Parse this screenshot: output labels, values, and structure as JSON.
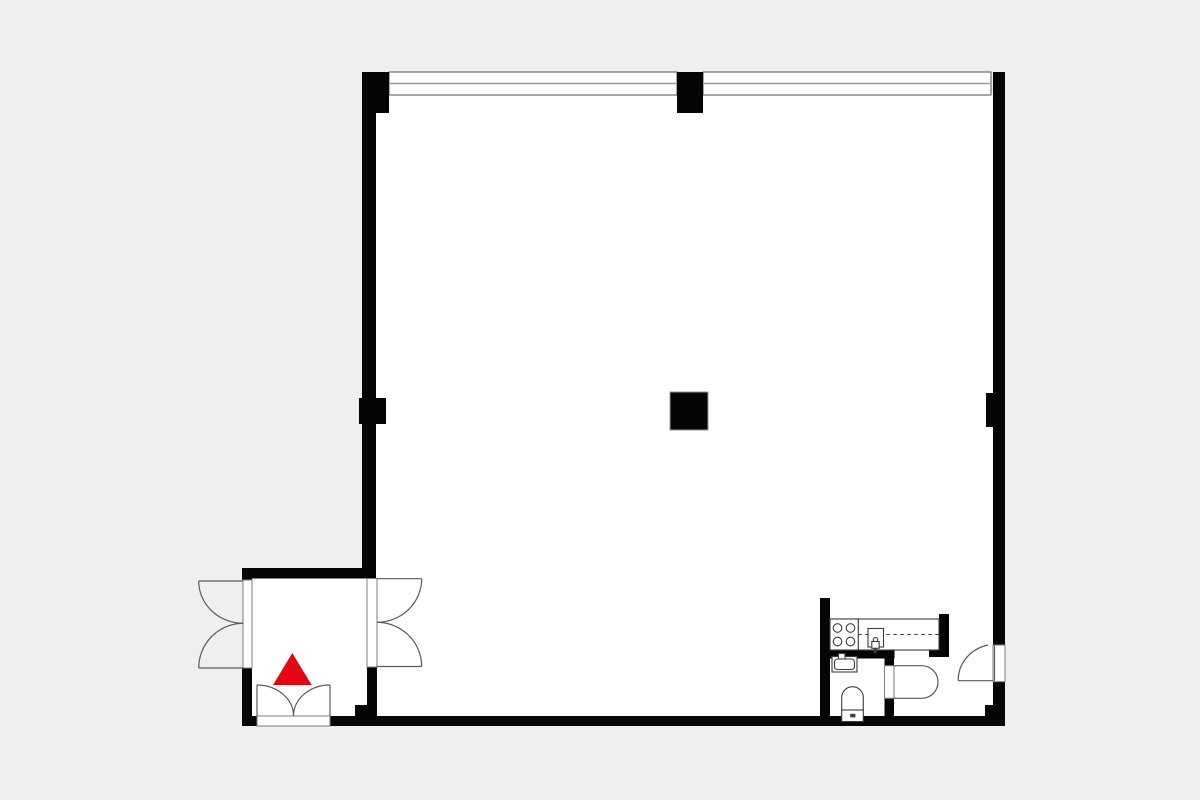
{
  "plan": {
    "type": "apartment-floor-plan",
    "canvas": {
      "width": 1200,
      "height": 800
    },
    "colors": {
      "background": "#efefef",
      "floor": "#ffffff",
      "wall": "#050505",
      "window_border": "#5f5f5f",
      "window_mullion": "#9a9a9a",
      "frame_border": "#7d7d7d",
      "door_line": "#5a5a5a",
      "fixture_line": "#3c3c3c",
      "column_outline": "#9a9a9a",
      "accent_red": "#e30613"
    },
    "floors": [
      {
        "name": "main-room-floor",
        "r": [
          376,
          94,
          617,
          622
        ]
      },
      {
        "name": "vestibule-floor",
        "r": [
          243,
          578,
          133,
          138
        ]
      }
    ],
    "windows": [
      {
        "name": "window-band-left",
        "r": [
          389,
          72,
          288,
          23
        ]
      },
      {
        "name": "window-band-right",
        "r": [
          703,
          72,
          288,
          23
        ]
      }
    ],
    "walls": [
      {
        "name": "top-left-corner-block",
        "r": [
          362,
          72,
          27,
          41
        ]
      },
      {
        "name": "left-wall",
        "r": [
          362,
          72,
          14,
          506
        ]
      },
      {
        "name": "left-wall-pier",
        "r": [
          359,
          398,
          27,
          26
        ]
      },
      {
        "name": "top-wall-pier",
        "r": [
          677,
          72,
          26,
          41
        ]
      },
      {
        "name": "right-wall-upper",
        "r": [
          993,
          72,
          12,
          573
        ]
      },
      {
        "name": "right-wall-pier",
        "r": [
          986,
          393,
          7,
          34
        ]
      },
      {
        "name": "right-wall-lower",
        "r": [
          993,
          681.7,
          12,
          44.3
        ]
      },
      {
        "name": "right-corner-step",
        "r": [
          985,
          705,
          8,
          11
        ]
      },
      {
        "name": "bottom-wall-left-stub",
        "r": [
          242,
          716,
          15,
          10
        ]
      },
      {
        "name": "bottom-wall-main",
        "r": [
          330,
          716,
          675,
          10
        ]
      },
      {
        "name": "vestibule-top-wall",
        "r": [
          242,
          568,
          134,
          10.5
        ]
      },
      {
        "name": "vestibule-left-wall-upper",
        "r": [
          242,
          568,
          10,
          12
        ]
      },
      {
        "name": "vestibule-left-wall-lower",
        "r": [
          242,
          668,
          10,
          58
        ]
      },
      {
        "name": "vestibule-right-wall-lower",
        "r": [
          367,
          667,
          10,
          49
        ]
      },
      {
        "name": "vestibule-right-wall-foot",
        "r": [
          355,
          705,
          22,
          11
        ]
      },
      {
        "name": "kitchen-left-wall",
        "r": [
          820,
          598,
          10,
          128
        ]
      },
      {
        "name": "kitchen-right-wall",
        "r": [
          939,
          614,
          10,
          43
        ]
      },
      {
        "name": "kitchen-right-wall-foot",
        "r": [
          929,
          648,
          20,
          9
        ]
      },
      {
        "name": "bathroom-top-wall",
        "r": [
          830,
          650,
          64.5,
          8.5
        ]
      },
      {
        "name": "bathroom-right-wall-upper",
        "r": [
          884.5,
          650,
          9.5,
          16
        ]
      },
      {
        "name": "bathroom-right-wall-lower",
        "r": [
          884.5,
          698.3,
          9.5,
          17.7
        ]
      }
    ],
    "column": {
      "name": "structural-column",
      "r": [
        670,
        392,
        38,
        38
      ]
    },
    "frames": [
      {
        "name": "entry-door-frame",
        "r": [
          243,
          580,
          9,
          88
        ]
      },
      {
        "name": "vestibule-inner-door-frame",
        "r": [
          367,
          578.5,
          10,
          88.5
        ]
      },
      {
        "name": "vestibule-bottom-door-frame",
        "r": [
          257,
          716,
          73,
          10
        ]
      },
      {
        "name": "bathroom-door-frame",
        "r": [
          884.5,
          665.7,
          9.5,
          32.6
        ]
      },
      {
        "name": "side-door-frame",
        "r": [
          993,
          645,
          12,
          36.7
        ]
      }
    ],
    "door_lines": [
      {
        "name": "entry-door-leaf-top",
        "p": [
          198.7,
          581,
          243,
          581
        ]
      },
      {
        "name": "entry-door-leaf-bottom",
        "p": [
          198.7,
          668,
          243,
          668
        ]
      },
      {
        "name": "inner-door-leaf-top",
        "p": [
          377,
          578.7,
          421.7,
          578.7
        ]
      },
      {
        "name": "inner-door-leaf-bottom",
        "p": [
          377,
          666.5,
          421.7,
          666.5
        ]
      },
      {
        "name": "bottom-door-leaf-left",
        "p": [
          257,
          685,
          257,
          716
        ]
      },
      {
        "name": "bottom-door-leaf-right",
        "p": [
          330,
          685,
          330,
          716
        ]
      },
      {
        "name": "side-door-leaf-open",
        "p": [
          958.3,
          680.7,
          993,
          680.7
        ]
      },
      {
        "name": "side-door-leaf-closed",
        "p": [
          994.5,
          645,
          994.5,
          681
        ]
      }
    ],
    "door_arcs": [
      {
        "name": "entry-door-swing-top",
        "d": "M198.7,581 A44.6,42.3 0 0 0 243.3,623.3"
      },
      {
        "name": "entry-door-swing-bottom",
        "d": "M198.7,668 A44.6,44.7 0 0 1 243.3,623.3"
      },
      {
        "name": "inner-door-swing-top",
        "d": "M421.7,578.7 A44.7,43.6 0 0 1 377,622.3"
      },
      {
        "name": "inner-door-swing-bottom",
        "d": "M421.7,666.5 A44.7,44.2 0 0 0 377,622.3"
      },
      {
        "name": "bottom-door-swing-left",
        "d": "M257,685 A36.5,31 0 0 1 293.5,716"
      },
      {
        "name": "bottom-door-swing-right",
        "d": "M330,685 A36.5,31 0 0 0 293.5,716"
      },
      {
        "name": "bathroom-door-swing",
        "d": "M893.3,665.7 L921.7,665.7 A16.3,16.3 0 0 1 921.7,698.3 L893.3,698.3"
      },
      {
        "name": "side-door-swing",
        "d": "M958.3,680.7 A38.4,35.7 0 0 1 988,645"
      }
    ],
    "fixtures": {
      "counter": {
        "name": "kitchen-counter",
        "r": [
          830,
          619,
          109,
          31
        ]
      },
      "dashes": [
        {
          "name": "counter-divider-vertical",
          "p": [
            858.3,
            619.5,
            858.3,
            649.5
          ]
        },
        {
          "name": "counter-divider-horizontal",
          "p": [
            858.3,
            634.5,
            939,
            634.5
          ]
        }
      ],
      "stove": {
        "name": "stove",
        "r": [
          830,
          619,
          28.3,
          31
        ],
        "burner_r": 4.3,
        "burners": [
          [
            837.5,
            628
          ],
          [
            850.5,
            628
          ],
          [
            837.5,
            641.5
          ],
          [
            850.5,
            641.5
          ]
        ]
      },
      "kitchen_sink": {
        "name": "kitchen-sink",
        "basin": [
          868,
          628.5,
          15.5,
          18.5
        ],
        "drain": [
          875.5,
          639.8,
          2.2
        ],
        "faucet": [
          871.8,
          641.5,
          7.4,
          6.8
        ],
        "stem": [
          873.9,
          648.3,
          2.8,
          5
        ]
      },
      "bath_sink": {
        "name": "bathroom-sink",
        "outer": [
          832,
          656.5,
          25,
          15.5
        ],
        "inner": [
          834.5,
          659,
          20,
          10.5
        ],
        "faucet": [
          838.5,
          653.5,
          6.5,
          5.5
        ]
      },
      "toilet": {
        "name": "toilet",
        "bowl": "M841.7,710 L841.7,697.5 A10.8,10.8 0 0 1 863.3,697.5 L863.3,710 Z",
        "cistern": [
          841.7,
          710,
          21.6,
          11.5
        ],
        "button": [
          850.2,
          713.8,
          5.2,
          3.6
        ]
      }
    },
    "marker": {
      "name": "entrance-marker",
      "shape": "triangle",
      "d": "M292.3,653 L311.7,685 L273,685 Z",
      "color": "#e30613"
    }
  }
}
